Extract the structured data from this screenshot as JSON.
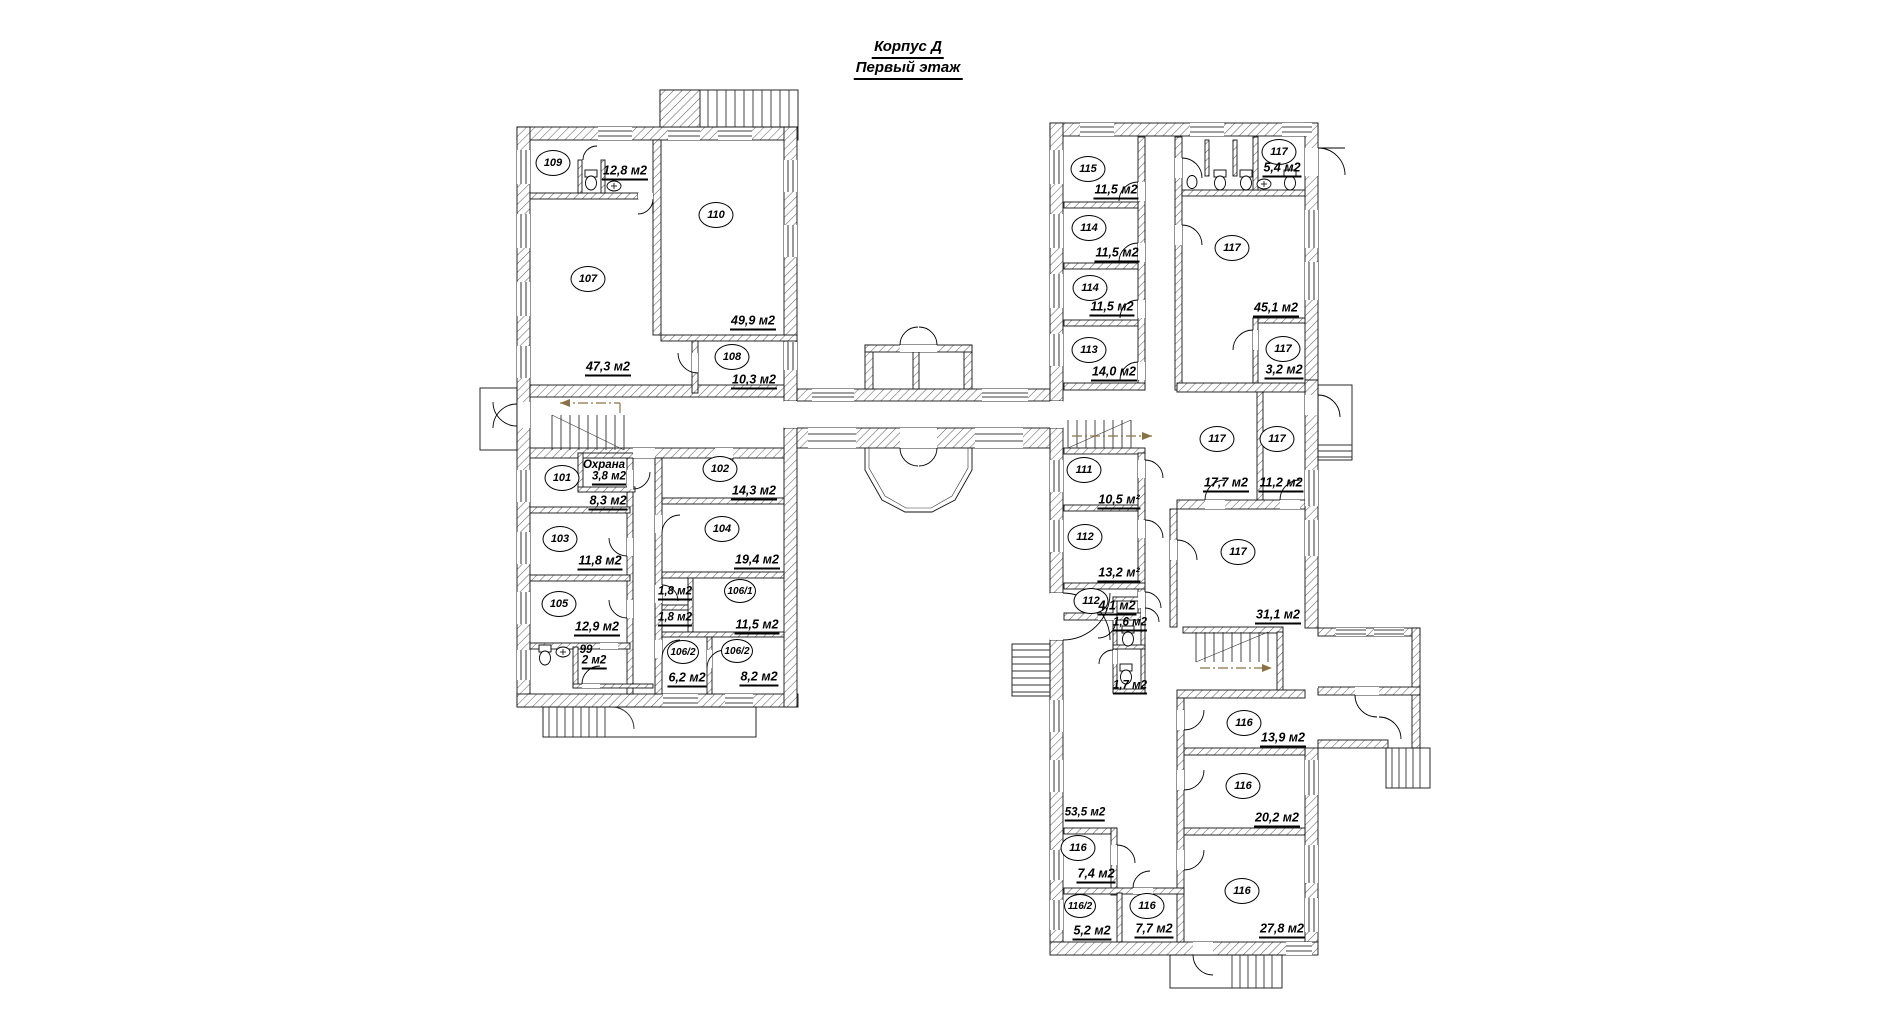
{
  "title": {
    "line1": "Корпус Д",
    "line2": "Первый этаж"
  },
  "rooms": [
    {
      "n": "109",
      "area": "12,8 м2",
      "cx": 553,
      "cy": 163,
      "ax": 625,
      "ay": 172
    },
    {
      "n": "110",
      "area": "49,9 м2",
      "cx": 716,
      "cy": 215,
      "ax": 753,
      "ay": 322
    },
    {
      "n": "107",
      "area": "47,3 м2",
      "cx": 588,
      "cy": 279,
      "ax": 608,
      "ay": 368
    },
    {
      "n": "108",
      "area": "10,3 м2",
      "cx": 732,
      "cy": 357,
      "ax": 754,
      "ay": 381
    },
    {
      "n": "101",
      "area": "8,3 м2",
      "cx": 562,
      "cy": 478,
      "ax": 608,
      "ay": 502
    },
    {
      "n": "102",
      "area": "14,3 м2",
      "cx": 720,
      "cy": 469,
      "ax": 754,
      "ay": 492
    },
    {
      "n": "103",
      "area": "11,8 м2",
      "cx": 560,
      "cy": 539,
      "ax": 600,
      "ay": 562
    },
    {
      "n": "104",
      "area": "19,4 м2",
      "cx": 722,
      "cy": 529,
      "ax": 757,
      "ay": 561
    },
    {
      "n": "105",
      "area": "12,9 м2",
      "cx": 559,
      "cy": 604,
      "ax": 597,
      "ay": 628
    },
    {
      "n": "106/1",
      "area": "11,5 м2",
      "cx": 740,
      "cy": 591,
      "ax": 757,
      "ay": 626
    },
    {
      "n": "106/2",
      "area": "6,2 м2",
      "cx": 683,
      "cy": 652,
      "ax": 687,
      "ay": 679
    },
    {
      "n": "106/2",
      "area": "8,2 м2",
      "cx": 737,
      "cy": 651,
      "ax": 759,
      "ay": 678
    },
    {
      "n": "115",
      "area": "11,5 м2",
      "cx": 1088,
      "cy": 169,
      "ax": 1116,
      "ay": 191
    },
    {
      "n": "114",
      "area": "11,5 м2",
      "cx": 1089,
      "cy": 228,
      "ax": 1117,
      "ay": 254
    },
    {
      "n": "114",
      "area": "11,5 м2",
      "cx": 1090,
      "cy": 288,
      "ax": 1112,
      "ay": 308
    },
    {
      "n": "113",
      "area": "14,0 м2",
      "cx": 1089,
      "cy": 350,
      "ax": 1114,
      "ay": 373
    },
    {
      "n": "117",
      "area": "5,4 м2",
      "cx": 1279,
      "cy": 152,
      "ax": 1282,
      "ay": 169
    },
    {
      "n": "117",
      "area": "45,1 м2",
      "cx": 1232,
      "cy": 248,
      "ax": 1276,
      "ay": 309
    },
    {
      "n": "117",
      "area": "3,2 м2",
      "cx": 1283,
      "cy": 349,
      "ax": 1284,
      "ay": 371
    },
    {
      "n": "117",
      "area": "17,7 м2",
      "cx": 1217,
      "cy": 439,
      "ax": 1226,
      "ay": 484
    },
    {
      "n": "117",
      "area": "11,2 м2",
      "cx": 1277,
      "cy": 439,
      "ax": 1281,
      "ay": 484
    },
    {
      "n": "111",
      "area": "10,5 м²",
      "cx": 1084,
      "cy": 470,
      "ax": 1119,
      "ay": 501
    },
    {
      "n": "112",
      "area": "13,2 м²",
      "cx": 1085,
      "cy": 537,
      "ax": 1119,
      "ay": 574
    },
    {
      "n": "112",
      "area": "4,1 м2",
      "cx": 1091,
      "cy": 601,
      "ax": 1117,
      "ay": 607
    },
    {
      "n": "117",
      "area": "31,1 м2",
      "cx": 1238,
      "cy": 552,
      "ax": 1278,
      "ay": 616
    },
    {
      "n": "116",
      "area": "13,9 м2",
      "cx": 1244,
      "cy": 723,
      "ax": 1283,
      "ay": 739
    },
    {
      "n": "116",
      "area": "20,2 м2",
      "cx": 1243,
      "cy": 786,
      "ax": 1277,
      "ay": 819
    },
    {
      "n": "116",
      "area": "27,8 м2",
      "cx": 1242,
      "cy": 891,
      "ax": 1282,
      "ay": 930
    },
    {
      "n": "116",
      "area": "7,4 м2",
      "cx": 1078,
      "cy": 848,
      "ax": 1096,
      "ay": 875
    },
    {
      "n": "116/2",
      "area": "5,2 м2",
      "cx": 1080,
      "cy": 906,
      "ax": 1092,
      "ay": 932
    },
    {
      "n": "116",
      "area": "7,7 м2",
      "cx": 1147,
      "cy": 906,
      "ax": 1154,
      "ay": 930
    }
  ],
  "labels": [
    {
      "text": "Охрана",
      "x": 604,
      "y": 465,
      "u": false
    },
    {
      "text": "3,8 м2",
      "x": 609,
      "y": 478,
      "u": true
    },
    {
      "text": "99",
      "x": 586,
      "y": 650,
      "u": false
    },
    {
      "text": "2 м2",
      "x": 594,
      "y": 662,
      "u": true
    },
    {
      "text": "1,8 м2",
      "x": 675,
      "y": 593,
      "u": true
    },
    {
      "text": "1,8 м2",
      "x": 675,
      "y": 619,
      "u": true
    },
    {
      "text": "1,6 м2",
      "x": 1130,
      "y": 624,
      "u": true
    },
    {
      "text": "1,7 м2",
      "x": 1130,
      "y": 687,
      "u": true
    },
    {
      "text": "53,5 м2",
      "x": 1085,
      "y": 814,
      "u": true
    }
  ],
  "colors": {
    "wall_line": "#111111",
    "hatch": "#666666",
    "route": "#8a7144",
    "background": "#ffffff"
  }
}
